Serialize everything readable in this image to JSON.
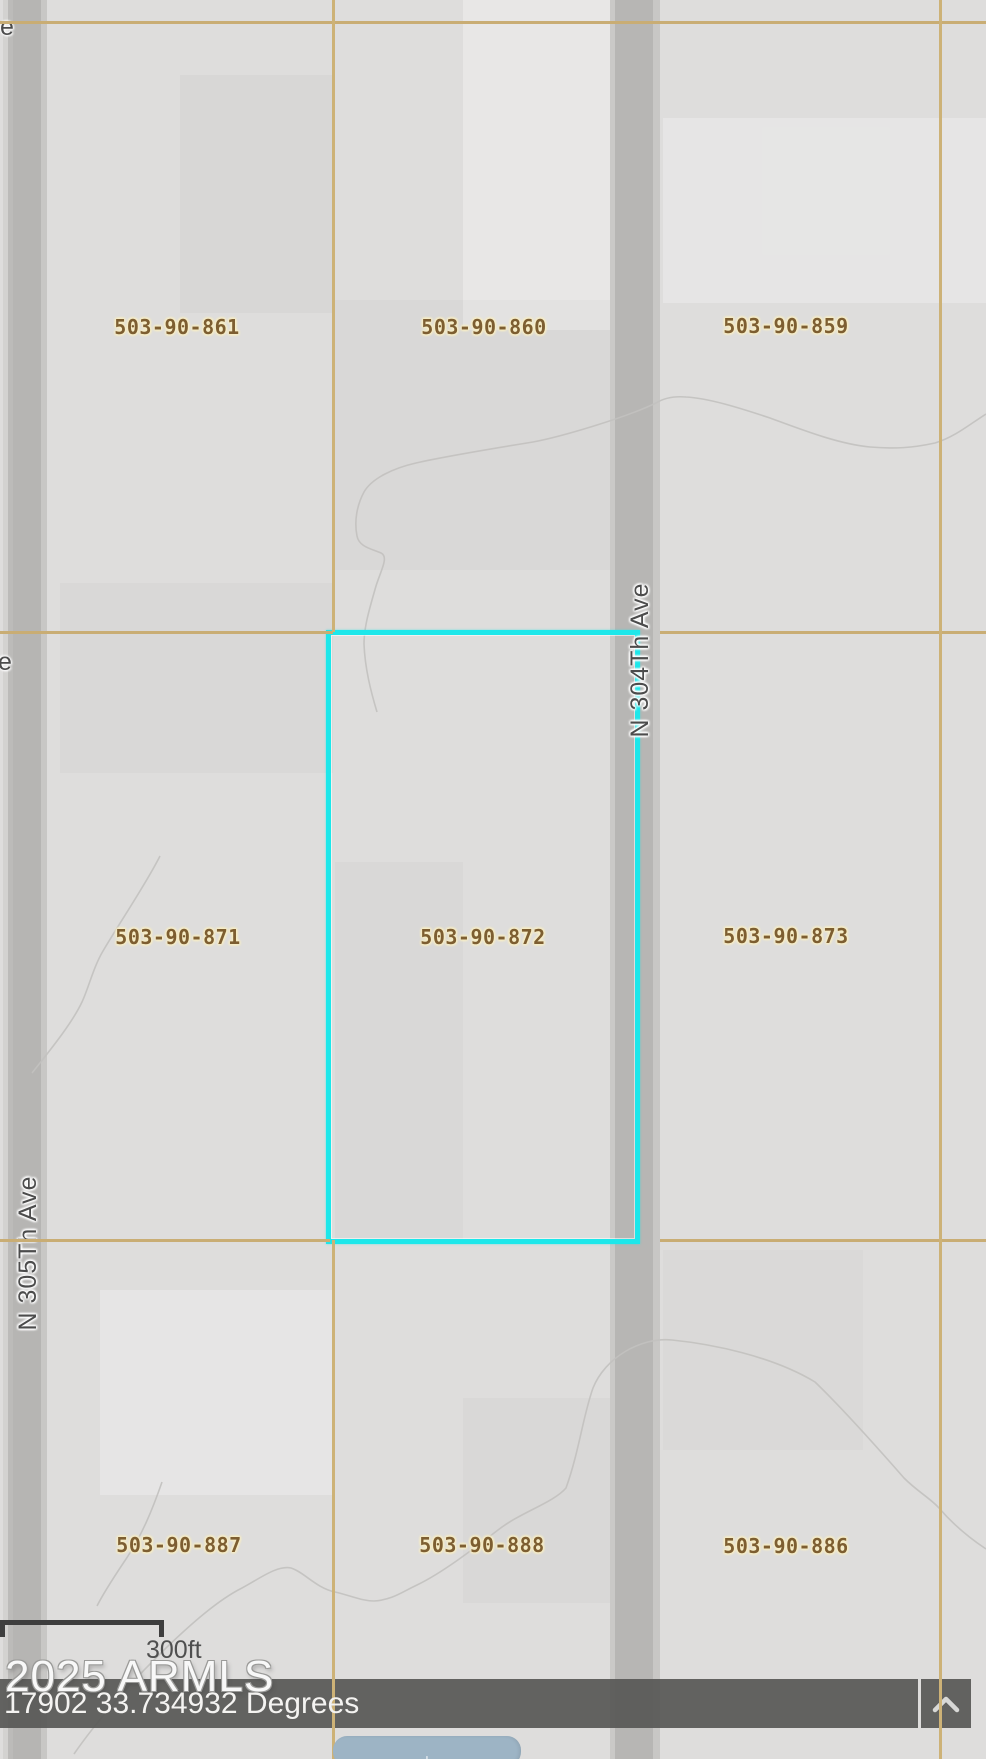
{
  "map": {
    "selected_parcel": "503-90-872",
    "parcels": [
      {
        "id": "503-90-861"
      },
      {
        "id": "503-90-860"
      },
      {
        "id": "503-90-859"
      },
      {
        "id": "503-90-871"
      },
      {
        "id": "503-90-872"
      },
      {
        "id": "503-90-873"
      },
      {
        "id": "503-90-887"
      },
      {
        "id": "503-90-888"
      },
      {
        "id": "503-90-886"
      }
    ],
    "roads": [
      {
        "name": "N 305Th Ave"
      },
      {
        "name": "N 304Th Ave"
      }
    ],
    "clipped_labels": [
      {
        "text": "e"
      },
      {
        "text": "e"
      }
    ],
    "colors": {
      "background": "#dedddc",
      "parcel_line": "#c9ad74",
      "parcel_label": "#7d5e31",
      "parcel_label_halo": "#f7edc6",
      "selection_outline": "#1de7ea",
      "road_fill": "#b7b6b4",
      "road_label": "#4c4c4c",
      "contour": "#c2c1bf",
      "status_band": "#585856"
    }
  },
  "scale_bar": {
    "label": "300ft"
  },
  "watermark": {
    "text": "2025 ARMLS"
  },
  "status_bar": {
    "coordinates": "17902 33.734932 Degrees",
    "collapse_icon": "chevron-up"
  },
  "controls": {
    "map_button_glyph": "+"
  }
}
